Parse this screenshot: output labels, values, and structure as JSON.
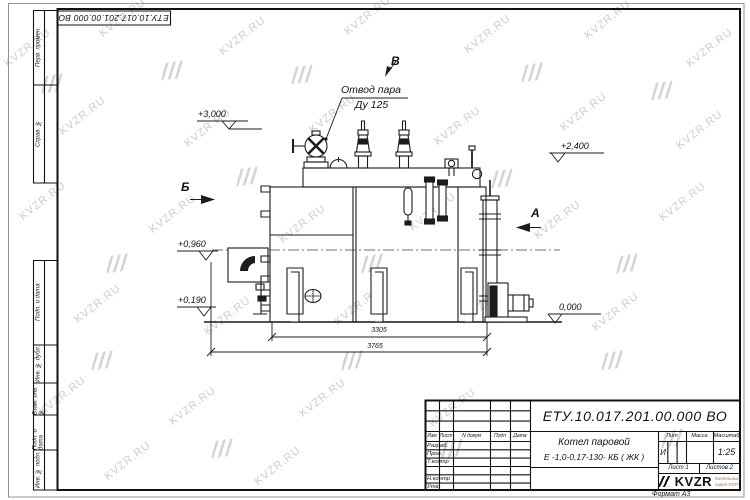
{
  "doc_number": "ЕТУ.10.017.201.00.000 ВО",
  "watermark": {
    "text": "KVZR.RU"
  },
  "frame": {
    "left_labels": [
      "Перв. примен.",
      "Справ. №",
      "Подп. и дата",
      "Инв. № дубл.",
      "Взам. инв. №",
      "Подп. и дата",
      "Инв. № подл."
    ],
    "format_label": "Формат А3"
  },
  "drawing": {
    "callout": {
      "line1": "Отвод пара",
      "line2": "Ду 125"
    },
    "sections": {
      "b": "Б",
      "v": "В",
      "a": "А"
    },
    "elevations": {
      "top": "+3,000",
      "right": "+2,400",
      "mid": "+0,960",
      "low": "+0,190",
      "ground": "0,000"
    },
    "dimensions": {
      "inner": "3305",
      "overall": "3765"
    }
  },
  "title_block": {
    "name_line1": "Котел паровой",
    "name_line2": "Е -1,0-0,17-130- КБ ( ЖК )",
    "columns": {
      "izm": "Изм",
      "list": "Лист",
      "doc": "N докум",
      "podp": "Подп",
      "data": "Дата"
    },
    "rows": [
      "Разраб.",
      "Пров.",
      "Т.контр",
      "Н.контр",
      "Утв."
    ],
    "lit_header": "Лит",
    "mass_header": "Масса",
    "scale_header": "Масштаб",
    "lit_value": "И",
    "scale_value": "1:25",
    "sheet_info": "Лист 1",
    "sheets_info": "Листов 2",
    "logo_text": "KVZR",
    "logo_sub1": "Котельный",
    "logo_sub2": "завод РЭП"
  }
}
